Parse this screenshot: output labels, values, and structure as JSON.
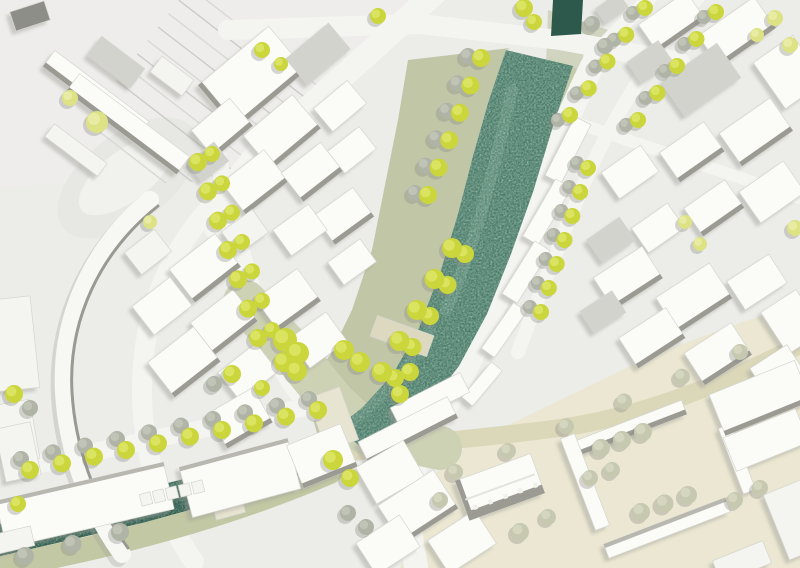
{
  "meta": {
    "type": "urban-masterplan-site-plan",
    "canvas": {
      "width": 800,
      "height": 568
    }
  },
  "palette": {
    "bg": "#ecece9",
    "railZone": "#eeedeb",
    "street": "#f4f4f1",
    "plaza": "#cdd2b5",
    "beigeZone": "#ebe7d2",
    "streetBeige": "#dbd8ba",
    "bankSage": "#c0c6a6",
    "bankSage2": "#c6cbac",
    "canalBankBeige": "#ded9c0",
    "canalBankSage": "#c2c8a4",
    "riverMain": "#4b7c6a",
    "riverCanal": "#2c5a4c",
    "riverTop": "#2c594b",
    "bridgeBeige": "#e8e4d2",
    "bridgeBeige2": "#ddd8c0",
    "oval1": "#e7e7e3",
    "oval2": "#f1f1ee",
    "bW": "#fbfbf8",
    "bG": "#d3d3ce",
    "bD": "#8e8e88",
    "bP": "#f4f4f0",
    "face": "#9b9b93",
    "shadow": "#9e9e97",
    "treeShadow": "#8d8d86",
    "rail1": "#d8d8d4",
    "rail2": "#cbcbc7",
    "outline": "#d6d6d0",
    "arcFill": "#f7f7f4",
    "arcEdge": "#9a9a93",
    "tree": {
      "b": {
        "f": "#cad63b",
        "h": "#e2ea70"
      },
      "p": {
        "f": "#dde284",
        "h": "#edf0b0"
      },
      "g": {
        "f": "#b0b4a6",
        "h": "#c8cbbd"
      },
      "sg": {
        "f": "#c6c9b0",
        "h": "#dadcc6"
      }
    }
  },
  "railClip": [
    [
      0,
      0
    ],
    [
      428,
      0
    ],
    [
      300,
      118
    ],
    [
      235,
      180
    ],
    [
      0,
      190
    ]
  ],
  "rails": {
    "count": 11,
    "x0": 199.6,
    "y0": -26.6,
    "dx": 332,
    "dy": 256,
    "ox": -10.4,
    "oy": 13.4
  },
  "ground": {
    "railZone": [
      [
        0,
        0
      ],
      [
        430,
        0
      ],
      [
        252,
        168
      ],
      [
        0,
        188
      ]
    ],
    "oval": {
      "cx": 128,
      "cy": 178,
      "rx": 82,
      "ry": 44,
      "rot": -37
    },
    "ovalInner": {
      "cx": 126,
      "cy": 176,
      "rx": 56,
      "ry": 25,
      "rot": -37
    },
    "bankLeft": [
      [
        408,
        60
      ],
      [
        510,
        48
      ],
      [
        506,
        50
      ],
      [
        489,
        100
      ],
      [
        473,
        156
      ],
      [
        458,
        214
      ],
      [
        441,
        270
      ],
      [
        419,
        328
      ],
      [
        393,
        374
      ],
      [
        362,
        408
      ],
      [
        336,
        428
      ],
      [
        318,
        436
      ],
      [
        305,
        392
      ],
      [
        330,
        355
      ],
      [
        352,
        310
      ],
      [
        372,
        250
      ],
      [
        385,
        185
      ],
      [
        398,
        120
      ]
    ],
    "bankRight": [
      [
        573,
        66
      ],
      [
        590,
        82
      ],
      [
        562,
        148
      ],
      [
        540,
        212
      ],
      [
        516,
        274
      ],
      [
        492,
        332
      ],
      [
        462,
        384
      ],
      [
        432,
        422
      ],
      [
        402,
        450
      ],
      [
        372,
        458
      ],
      [
        368,
        452
      ],
      [
        398,
        434
      ],
      [
        428,
        406
      ],
      [
        459,
        366
      ],
      [
        487,
        314
      ],
      [
        511,
        254
      ],
      [
        533,
        192
      ],
      [
        553,
        126
      ]
    ],
    "bankTopRight": [
      [
        548,
        10
      ],
      [
        608,
        30
      ],
      [
        590,
        90
      ],
      [
        545,
        92
      ]
    ],
    "beigeZone": [
      [
        400,
        568
      ],
      [
        428,
        480
      ],
      [
        470,
        444
      ],
      [
        560,
        400
      ],
      [
        660,
        352
      ],
      [
        748,
        320
      ],
      [
        800,
        306
      ],
      [
        800,
        568
      ]
    ]
  },
  "streets": [
    {
      "n": "street-main-nw",
      "d": "M 434,-6 C 370,52 306,110 264,148 C 240,170 226,198 216,228",
      "w": 24,
      "c": "street"
    },
    {
      "n": "street-tree-lined-left",
      "d": "M 216,150 C 232,220 252,300 276,356 C 286,380 300,398 316,412",
      "w": 18,
      "c": "street"
    },
    {
      "n": "street-arc-west",
      "d": "M 238,180 C 168,240 140,318 142,398 C 144,458 162,516 194,562",
      "w": 20,
      "c": "street"
    },
    {
      "n": "street-top-cross",
      "d": "M 228,30 L 420,24 L 560,40 L 680,62",
      "w": 20,
      "c": "street"
    },
    {
      "n": "street-river-east-curve",
      "d": "M 592,66 C 556,140 530,212 504,282 C 478,348 452,398 428,438 C 410,468 404,508 416,566",
      "w": 24,
      "c": "street"
    },
    {
      "n": "street-outer-east",
      "d": "M 702,-8 C 646,62 606,130 582,188 C 560,242 538,298 518,352",
      "w": 14,
      "c": "street"
    },
    {
      "n": "street-top-right-spur",
      "d": "M 590,58 L 658,-10",
      "w": 14,
      "c": "street"
    },
    {
      "n": "street-cross-top-right",
      "d": "M 556,116 L 800,198",
      "w": 12,
      "c": "street"
    },
    {
      "n": "street-bottom-left",
      "d": "M -6,474 L 140,442 L 330,402",
      "w": 18,
      "c": "street"
    },
    {
      "n": "towpath-north-beige",
      "d": "M 340,440 C 240,478 120,505 -5,528",
      "w": 10,
      "c": "canalBankBeige"
    },
    {
      "n": "towpath-south-beige",
      "d": "M 330,455 C 230,498 120,528 -5,552",
      "w": 12,
      "c": "canalBankBeige"
    },
    {
      "n": "canal-south-green-band",
      "d": "M 330,472 C 230,515 120,545 -5,568",
      "w": 24,
      "c": "canalBankSage"
    },
    {
      "n": "street-beige-east",
      "d": "M 295,462 C 380,445 470,440 560,428 C 650,415 730,380 800,345",
      "w": 18,
      "c": "streetBeige"
    },
    {
      "n": "plaza-axis",
      "d": "M 245,302 L 295,355 L 333,402 L 365,432 L 440,448",
      "w": 44,
      "c": "plaza"
    }
  ],
  "river": {
    "top": [
      [
        553,
        0
      ],
      [
        583,
        0
      ],
      [
        581,
        34
      ],
      [
        551,
        36
      ]
    ],
    "main": [
      [
        506,
        50
      ],
      [
        489,
        100
      ],
      [
        473,
        156
      ],
      [
        458,
        214
      ],
      [
        441,
        270
      ],
      [
        419,
        328
      ],
      [
        393,
        374
      ],
      [
        362,
        408
      ],
      [
        336,
        428
      ],
      [
        368,
        452
      ],
      [
        398,
        434
      ],
      [
        428,
        406
      ],
      [
        459,
        366
      ],
      [
        487,
        314
      ],
      [
        511,
        254
      ],
      [
        533,
        192
      ],
      [
        553,
        126
      ],
      [
        573,
        66
      ]
    ],
    "canal": [
      [
        336,
        428
      ],
      [
        282,
        452
      ],
      [
        212,
        472
      ],
      [
        140,
        490
      ],
      [
        66,
        508
      ],
      [
        0,
        524
      ],
      [
        0,
        556
      ],
      [
        70,
        540
      ],
      [
        146,
        522
      ],
      [
        218,
        502
      ],
      [
        288,
        480
      ],
      [
        340,
        456
      ]
    ],
    "highlights": [
      {
        "d": "M 512,90 C 494,170 474,248 446,310",
        "w": 12,
        "c": "#7da692",
        "o": 0.35
      },
      {
        "d": "M 430,330 C 408,370 380,400 350,424",
        "w": 10,
        "c": "#7da692",
        "o": 0.3
      },
      {
        "d": "M 300,452 C 220,478 120,500 20,522",
        "w": 9,
        "c": "#6d9a86",
        "o": 0.3
      }
    ]
  },
  "bridges": [
    {
      "n": "bridge-canal",
      "x": 224,
      "y": 490,
      "w": 30,
      "h": 54,
      "r": -15,
      "c": "bridgeBeige"
    },
    {
      "n": "bridge-plaza",
      "x": 333,
      "y": 419,
      "w": 34,
      "h": 56,
      "r": -20,
      "c": "bridgeBeige"
    },
    {
      "n": "bridge-mid-river",
      "x": 402,
      "y": 336,
      "w": 60,
      "h": 22,
      "r": 20,
      "c": "bridgeBeige2"
    }
  ],
  "arcBuilding": {
    "body": "M 150,200 C 92,248 60,318 64,392 C 67,446 86,504 122,554",
    "edge": "M 158,206 C 100,252 68,320 72,392 C 75,444 93,500 128,548",
    "w": 18
  },
  "buildings": [
    [
      30,
      16,
      36,
      20,
      -18,
      "bD",
      ""
    ],
    [
      96,
      94,
      118,
      20,
      37,
      "bW",
      "b"
    ],
    [
      128,
      124,
      138,
      22,
      37,
      "bW",
      "b"
    ],
    [
      76,
      150,
      66,
      16,
      37,
      "bP",
      ""
    ],
    [
      116,
      62,
      54,
      24,
      37,
      "bG",
      ""
    ],
    [
      172,
      76,
      40,
      20,
      37,
      "bP",
      ""
    ],
    [
      252,
      78,
      92,
      58,
      -40,
      "bW",
      "lb"
    ],
    [
      318,
      54,
      56,
      34,
      -40,
      "bG",
      ""
    ],
    [
      222,
      128,
      50,
      36,
      -40,
      "bW",
      "b"
    ],
    [
      282,
      132,
      64,
      44,
      -40,
      "bW",
      "b"
    ],
    [
      340,
      106,
      44,
      30,
      -40,
      "bW",
      ""
    ],
    [
      255,
      182,
      54,
      40,
      -38,
      "bW",
      "b"
    ],
    [
      312,
      172,
      50,
      36,
      -38,
      "bW",
      "b"
    ],
    [
      208,
      162,
      34,
      24,
      -38,
      "bG",
      ""
    ],
    [
      352,
      150,
      40,
      28,
      -38,
      "bW",
      ""
    ],
    [
      344,
      216,
      48,
      36,
      -36,
      "bW",
      "b"
    ],
    [
      300,
      230,
      44,
      32,
      -36,
      "bW",
      ""
    ],
    [
      352,
      262,
      40,
      28,
      -36,
      "bW",
      ""
    ],
    [
      245,
      232,
      38,
      28,
      -36,
      "bP",
      ""
    ],
    [
      205,
      268,
      58,
      42,
      -38,
      "bW",
      "b"
    ],
    [
      162,
      306,
      48,
      36,
      -38,
      "bW",
      ""
    ],
    [
      224,
      322,
      54,
      40,
      -38,
      "bW",
      "b"
    ],
    [
      184,
      362,
      58,
      44,
      -38,
      "bW",
      "b"
    ],
    [
      248,
      372,
      48,
      36,
      -38,
      "bW",
      ""
    ],
    [
      148,
      252,
      38,
      28,
      -38,
      "bP",
      ""
    ],
    [
      288,
      300,
      52,
      40,
      -36,
      "bW",
      "b"
    ],
    [
      318,
      340,
      46,
      36,
      -36,
      "bW",
      ""
    ],
    [
      240,
      418,
      52,
      40,
      -30,
      "bW",
      "b"
    ],
    [
      12,
      344,
      46,
      92,
      -6,
      "bP",
      ""
    ],
    [
      16,
      432,
      38,
      60,
      -10,
      "bP",
      ""
    ],
    [
      568,
      150,
      66,
      18,
      -63,
      "bW",
      ""
    ],
    [
      547,
      212,
      66,
      18,
      -60,
      "bW",
      ""
    ],
    [
      526,
      272,
      62,
      18,
      -58,
      "bW",
      ""
    ],
    [
      504,
      330,
      56,
      16,
      -55,
      "bW",
      ""
    ],
    [
      482,
      384,
      46,
      14,
      -50,
      "bW",
      ""
    ],
    [
      612,
      8,
      28,
      18,
      -35,
      "bG",
      ""
    ],
    [
      672,
      22,
      58,
      34,
      -35,
      "bW",
      "b"
    ],
    [
      737,
      32,
      68,
      38,
      -35,
      "bW",
      "b"
    ],
    [
      789,
      72,
      48,
      56,
      -35,
      "bW",
      ""
    ],
    [
      701,
      80,
      68,
      42,
      -35,
      "bG",
      ""
    ],
    [
      650,
      62,
      38,
      26,
      -35,
      "bG",
      ""
    ],
    [
      756,
      132,
      62,
      40,
      -35,
      "bW",
      "b"
    ],
    [
      692,
      152,
      54,
      36,
      -35,
      "bW",
      "b"
    ],
    [
      630,
      172,
      48,
      32,
      -35,
      "bW",
      ""
    ],
    [
      772,
      192,
      54,
      38,
      -35,
      "bW",
      ""
    ],
    [
      714,
      208,
      50,
      34,
      -35,
      "bW",
      "b"
    ],
    [
      658,
      228,
      44,
      30,
      -35,
      "bW",
      ""
    ],
    [
      611,
      240,
      40,
      28,
      -35,
      "bG",
      ""
    ],
    [
      628,
      278,
      58,
      38,
      -33,
      "bW",
      "b"
    ],
    [
      694,
      298,
      64,
      42,
      -33,
      "bW",
      "b"
    ],
    [
      757,
      282,
      50,
      34,
      -33,
      "bW",
      ""
    ],
    [
      792,
      322,
      42,
      50,
      -33,
      "bW",
      ""
    ],
    [
      652,
      338,
      56,
      36,
      -33,
      "bW",
      "b"
    ],
    [
      718,
      354,
      56,
      38,
      -33,
      "bW",
      "b"
    ],
    [
      777,
      370,
      44,
      32,
      -33,
      "bW",
      ""
    ],
    [
      603,
      312,
      38,
      26,
      -33,
      "bG",
      ""
    ],
    [
      85,
      505,
      172,
      48,
      -13,
      "bW",
      "t"
    ],
    [
      240,
      478,
      112,
      52,
      -15,
      "bW",
      "t"
    ],
    [
      322,
      456,
      58,
      46,
      -22,
      "bW",
      "b"
    ],
    [
      18,
      452,
      36,
      54,
      -12,
      "bP",
      ""
    ],
    [
      14,
      540,
      38,
      20,
      -13,
      "bP",
      ""
    ],
    [
      146,
      499,
      11,
      12,
      -14,
      "bP",
      ""
    ],
    [
      159,
      496,
      11,
      12,
      -14,
      "bP",
      ""
    ],
    [
      172,
      493,
      11,
      12,
      -14,
      "bP",
      ""
    ],
    [
      185,
      490,
      11,
      12,
      -14,
      "bP",
      ""
    ],
    [
      198,
      487,
      11,
      12,
      -14,
      "bP",
      ""
    ],
    [
      430,
      400,
      78,
      22,
      -27,
      "bW",
      ""
    ],
    [
      408,
      430,
      100,
      24,
      -27,
      "bW",
      "b"
    ],
    [
      390,
      472,
      55,
      42,
      -30,
      "bW",
      ""
    ],
    [
      418,
      507,
      66,
      46,
      -33,
      "bW",
      "b"
    ],
    [
      388,
      545,
      52,
      38,
      -33,
      "bW",
      ""
    ],
    [
      462,
      542,
      56,
      40,
      -33,
      "bW",
      ""
    ],
    [
      500,
      487,
      80,
      42,
      -20,
      "bW",
      "gable"
    ],
    [
      630,
      428,
      116,
      15,
      -21,
      "bW",
      "b"
    ],
    [
      585,
      482,
      15,
      98,
      -21,
      "bW",
      ""
    ],
    [
      667,
      528,
      130,
      15,
      -21,
      "bW",
      "t"
    ],
    [
      737,
      459,
      13,
      70,
      -21,
      "bW",
      ""
    ],
    [
      760,
      398,
      92,
      44,
      -22,
      "bW",
      "b"
    ],
    [
      766,
      440,
      78,
      36,
      -22,
      "bW",
      ""
    ],
    [
      795,
      520,
      40,
      70,
      -22,
      "bP",
      ""
    ],
    [
      742,
      562,
      54,
      24,
      -22,
      "bP",
      ""
    ]
  ],
  "treeRows": [
    [
      198,
      162,
      258,
      338,
      7,
      9,
      "b",
      14,
      -8,
      "b"
    ],
    [
      30,
      470,
      318,
      410,
      10,
      9,
      "b",
      -9,
      -11,
      "g"
    ],
    [
      588,
      168,
      541,
      312,
      7,
      8,
      "b",
      -11,
      -5,
      "g"
    ],
    [
      645,
      8,
      570,
      115,
      5,
      8,
      "b",
      -12,
      5,
      "g"
    ],
    [
      716,
      12,
      638,
      120,
      5,
      8,
      "b",
      -12,
      5,
      "g"
    ],
    [
      481,
      58,
      428,
      195,
      6,
      9,
      "b",
      -13,
      -2,
      "g"
    ],
    [
      452,
      248,
      382,
      372,
      5,
      10,
      "b",
      13,
      6,
      "b"
    ],
    [
      601,
      448,
      643,
      432,
      3,
      9,
      "sg",
      0,
      0,
      ""
    ],
    [
      641,
      512,
      688,
      495,
      3,
      9,
      "sg",
      0,
      0,
      ""
    ],
    [
      25,
      556,
      120,
      532,
      3,
      9,
      "g",
      0,
      0,
      ""
    ],
    [
      508,
      451,
      740,
      352,
      5,
      8,
      "sg",
      0,
      0,
      ""
    ]
  ],
  "trees": [
    [
      97,
      122,
      11,
      "p"
    ],
    [
      70,
      98,
      8,
      "p"
    ],
    [
      150,
      222,
      7,
      "p"
    ],
    [
      262,
      50,
      8,
      "b"
    ],
    [
      281,
      64,
      7,
      "b"
    ],
    [
      378,
      16,
      8,
      "b"
    ],
    [
      524,
      8,
      9,
      "b"
    ],
    [
      534,
      22,
      8,
      "b"
    ],
    [
      592,
      24,
      8,
      "g"
    ],
    [
      605,
      46,
      8,
      "g"
    ],
    [
      775,
      18,
      8,
      "p"
    ],
    [
      790,
      45,
      8,
      "p"
    ],
    [
      757,
      35,
      7,
      "p"
    ],
    [
      795,
      228,
      8,
      "p"
    ],
    [
      685,
      222,
      7,
      "p"
    ],
    [
      700,
      244,
      7,
      "p"
    ],
    [
      285,
      340,
      12,
      "b"
    ],
    [
      298,
      353,
      11,
      "b"
    ],
    [
      284,
      362,
      10,
      "b"
    ],
    [
      297,
      371,
      10,
      "b"
    ],
    [
      344,
      350,
      10,
      "b"
    ],
    [
      360,
      362,
      10,
      "b"
    ],
    [
      232,
      374,
      9,
      "b"
    ],
    [
      214,
      384,
      8,
      "g"
    ],
    [
      262,
      388,
      8,
      "b"
    ],
    [
      410,
      372,
      9,
      "b"
    ],
    [
      400,
      394,
      9,
      "b"
    ],
    [
      333,
      460,
      10,
      "b"
    ],
    [
      350,
      478,
      9,
      "b"
    ],
    [
      348,
      513,
      8,
      "g"
    ],
    [
      366,
      527,
      8,
      "g"
    ],
    [
      455,
      472,
      8,
      "sg"
    ],
    [
      440,
      500,
      8,
      "sg"
    ],
    [
      520,
      532,
      9,
      "sg"
    ],
    [
      548,
      517,
      8,
      "sg"
    ],
    [
      590,
      478,
      8,
      "sg"
    ],
    [
      612,
      470,
      8,
      "sg"
    ],
    [
      735,
      500,
      8,
      "sg"
    ],
    [
      760,
      488,
      8,
      "sg"
    ],
    [
      30,
      408,
      8,
      "g"
    ],
    [
      14,
      394,
      9,
      "b"
    ],
    [
      18,
      504,
      8,
      "b"
    ]
  ]
}
